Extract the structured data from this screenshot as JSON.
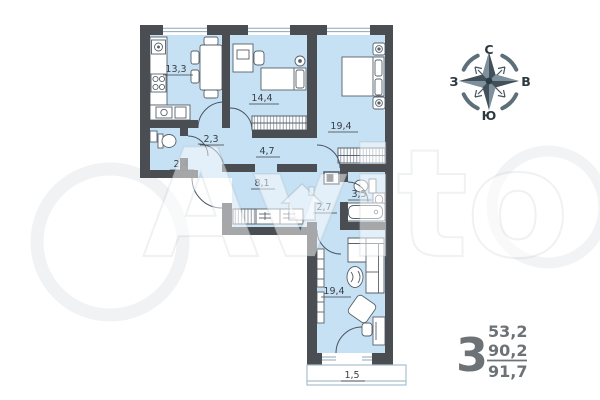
{
  "plan": {
    "rooms": [
      {
        "id": "kitchen",
        "name": "кухня",
        "label": "13,3"
      },
      {
        "id": "bedroom-1",
        "name": "спальня 1",
        "label": "14,4"
      },
      {
        "id": "bedroom-2",
        "name": "спальня 2",
        "label": "19,4"
      },
      {
        "id": "wc",
        "name": "туалет",
        "label": "2,4"
      },
      {
        "id": "hall",
        "name": "холл",
        "label": "2,3"
      },
      {
        "id": "corridor",
        "name": "коридор",
        "label": "4,7"
      },
      {
        "id": "hallway",
        "name": "прихожая",
        "label": "8,1"
      },
      {
        "id": "corridor-2",
        "name": "коридор 2",
        "label": "2,7"
      },
      {
        "id": "bathroom",
        "name": "ванная",
        "label": "3,5"
      },
      {
        "id": "living-room",
        "name": "гостиная",
        "label": "19,4"
      },
      {
        "id": "balcony",
        "name": "балкон",
        "label": "1,5"
      }
    ]
  },
  "compass": {
    "north": "С",
    "east": "В",
    "south": "Ю",
    "west": "З"
  },
  "summary": {
    "rooms_count": "3",
    "living_area": "53,2",
    "area": "90,2",
    "total_area": "91,7"
  },
  "watermark": {
    "brand": "Avito"
  },
  "colors": {
    "floor": "#c6e0f4",
    "wall": "#4a4e52",
    "furniture_stroke": "#57626c",
    "figures": "#6d7276",
    "compass_dark": "#42505a",
    "compass_light": "#7d909b"
  }
}
